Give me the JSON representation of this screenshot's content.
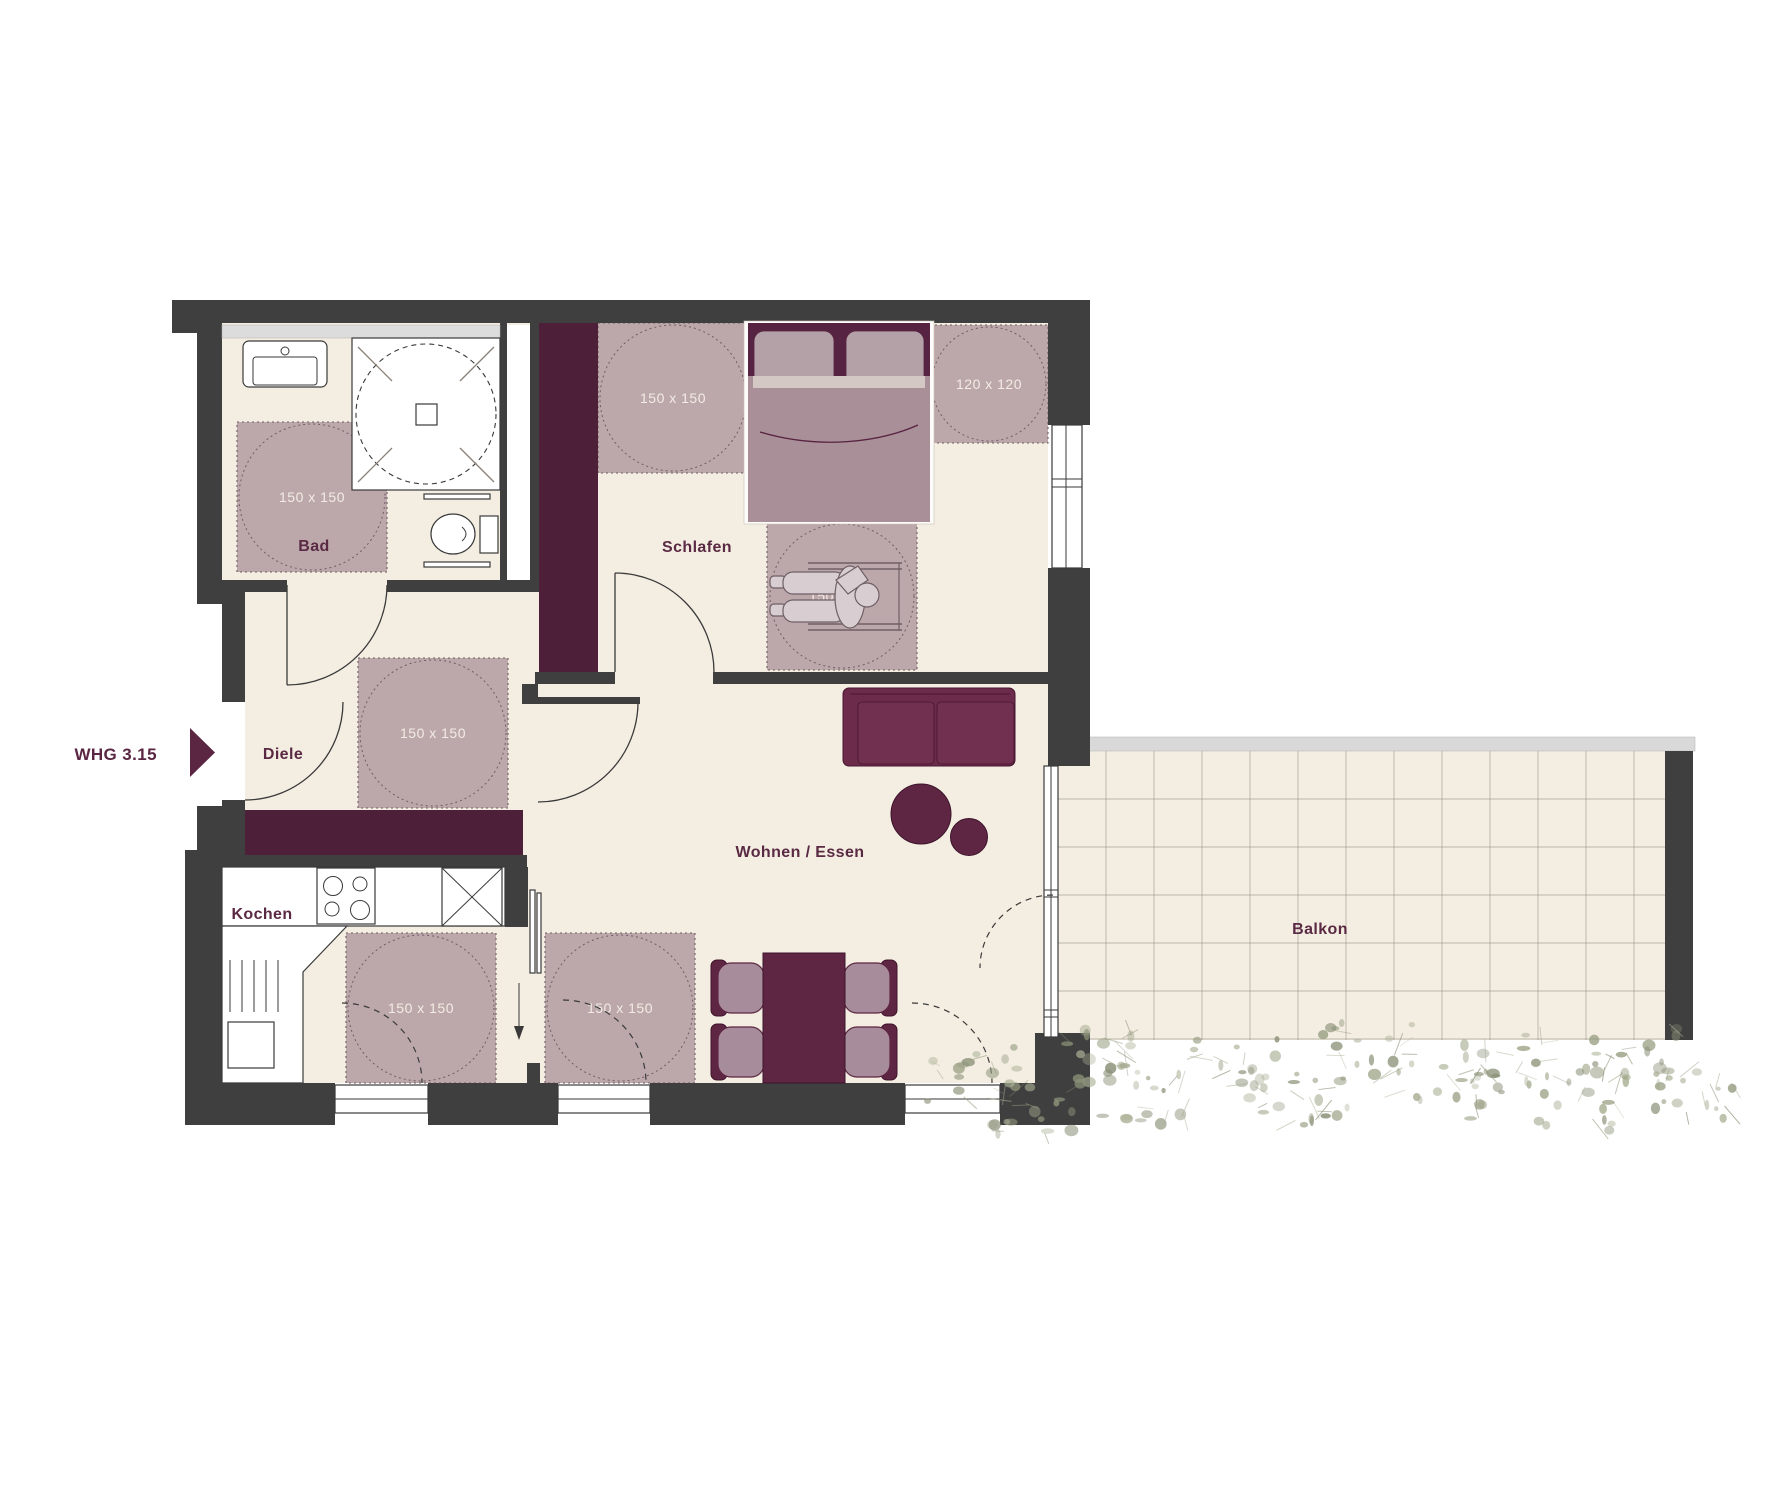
{
  "entrance": {
    "label": "WHG 3.15"
  },
  "rooms": {
    "bad": {
      "label": "Bad"
    },
    "diele": {
      "label": "Diele"
    },
    "kochen": {
      "label": "Kochen"
    },
    "schlafen": {
      "label": "Schlafen"
    },
    "wohnen_essen": {
      "label": "Wohnen / Essen"
    },
    "balkon": {
      "label": "Balkon"
    }
  },
  "clearances": [
    {
      "room": "bad",
      "label": "150 x 150"
    },
    {
      "room": "diele",
      "label": "150 x 150"
    },
    {
      "room": "schlafen",
      "label": "150 x 150"
    },
    {
      "room": "schlafen-window",
      "label": "120 x 120"
    },
    {
      "room": "schlafen-wheelchair",
      "label": "150 x 150"
    },
    {
      "room": "kochen-window",
      "label": "150 x 150"
    },
    {
      "room": "essen-window",
      "label": "150 x 150"
    }
  ],
  "colors": {
    "wall": "#3f3f3f",
    "floor": "#f4eee2",
    "accent": "#5a2642",
    "label": "#5a2943",
    "furniture_dark": "#5f2644",
    "sofa": "#6d2b4b",
    "wardrobe": "#4e1f38",
    "clearance": "#b7a2a6",
    "clearance_line": "#6f5d62",
    "clearance_text": "#f3ece4",
    "bed_blanket": "#a98f97",
    "pillow": "#b4a0a7",
    "chair_seat": "#a78d9b",
    "rail": "#d9d9d9",
    "tile_line": "#8d887e",
    "plant": "#9aa084",
    "line": "#3a3a3a"
  }
}
